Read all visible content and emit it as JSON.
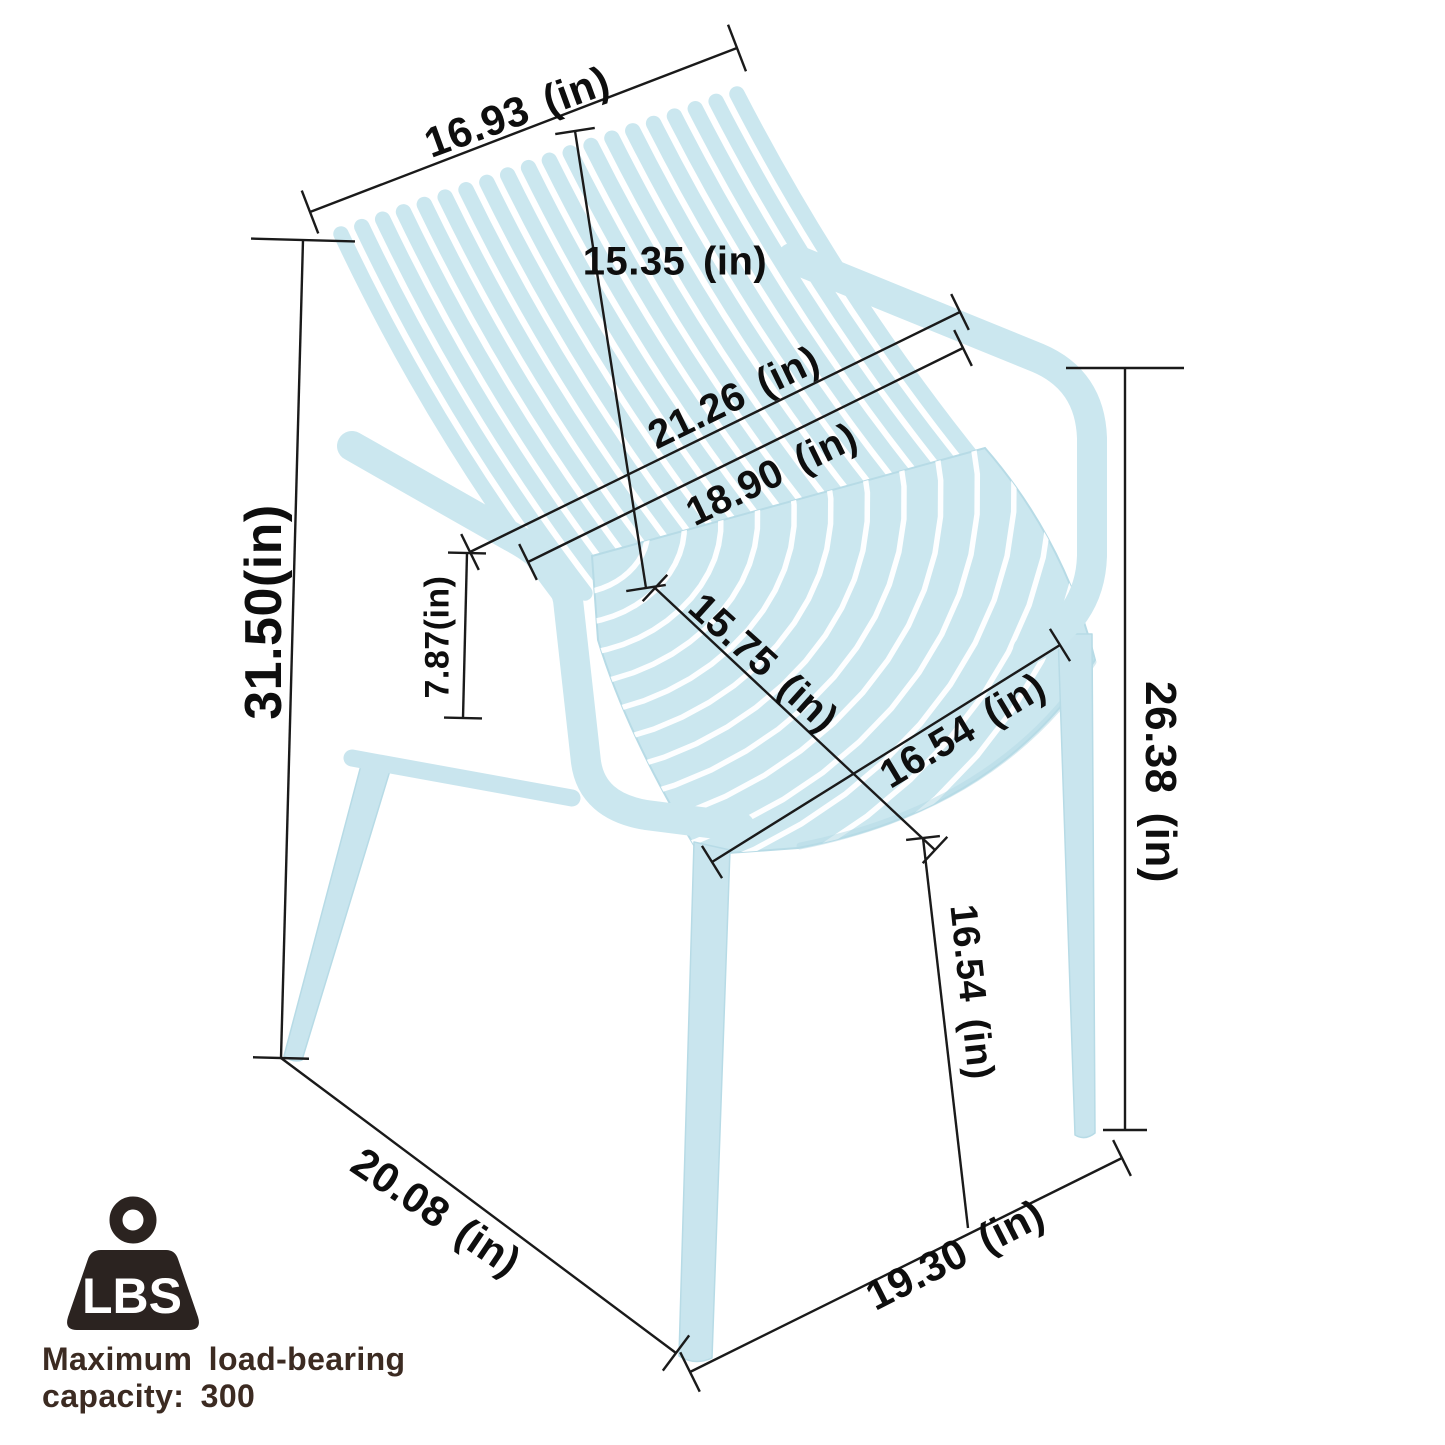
{
  "diagram": {
    "dimensions": {
      "backrest_width": "16.93 (in)",
      "backrest_height": "15.35 (in)",
      "overall_width": "21.26 (in)",
      "armrest_inner_width": "18.90 (in)",
      "overall_height": "31.50(in)",
      "armrest_above_seat": "7.87(in)",
      "seat_depth": "15.75 (in)",
      "seat_width": "16.54 (in)",
      "armrest_floor_height": "26.38 (in)",
      "seat_floor_height": "16.54 (in)",
      "base_depth": "20.08 (in)",
      "base_width": "19.30 (in)"
    },
    "load_badge": {
      "icon": "weight-icon",
      "icon_label": "LBS",
      "caption_line1": "Maximum load-bearing",
      "caption_line2": "capacity: 300"
    },
    "colors": {
      "chair": "#cbe7ef",
      "chair_shade": "#b7dbe6",
      "chair_leg": "#c9e5ee",
      "line": "#1a1a1a",
      "label_text": "#0e0e0e",
      "caption_text": "#3c2b22",
      "badge": "#2b2320",
      "background": "#ffffff"
    }
  }
}
